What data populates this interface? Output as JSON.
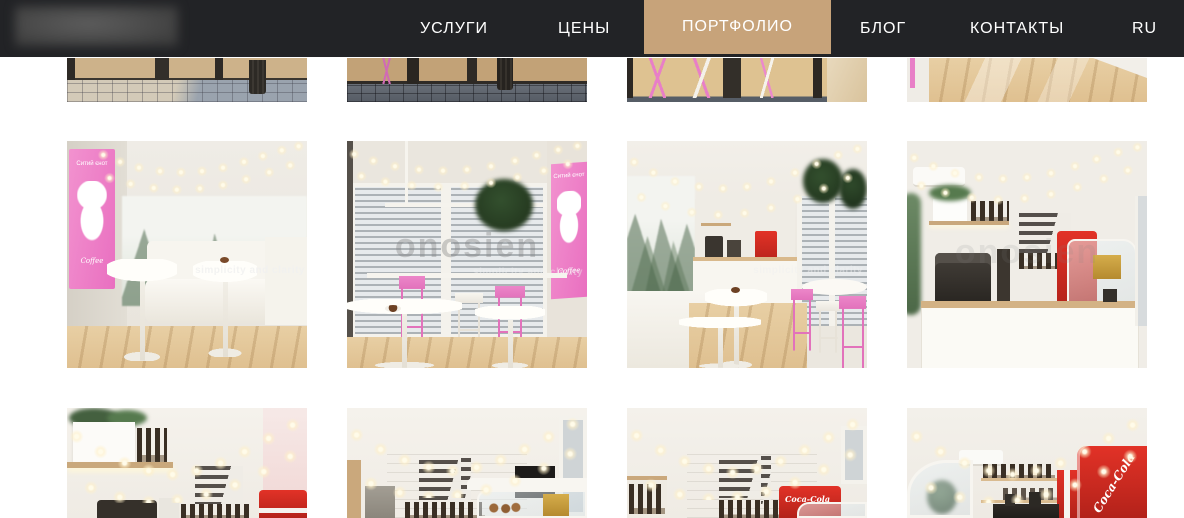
{
  "header": {
    "nav_items": [
      {
        "label": "УСЛУГИ",
        "active": false
      },
      {
        "label": "ЦЕНЫ",
        "active": false
      },
      {
        "label": "ПОРТФОЛИО",
        "active": true
      },
      {
        "label": "БЛОГ",
        "active": false
      },
      {
        "label": "КОНТАКТЫ",
        "active": false
      }
    ],
    "language": "RU",
    "colors": {
      "bar": "#222326",
      "active_bg": "#c7a37a",
      "text": "#ffffff"
    }
  },
  "watermark": {
    "big_text": "onosien",
    "tagline": "simplicity and clarity"
  },
  "mural": {
    "line1": "Ситий єнот",
    "line2": "Coffee"
  },
  "fridge_brand": "Coca-Cola",
  "portfolio": {
    "items": [
      {
        "alt": "Cafe exterior - storefront base and paved sidewalk"
      },
      {
        "alt": "Cafe exterior - entrance doors and dark pavement"
      },
      {
        "alt": "Cafe exterior - pink bar stools seen through the glazing"
      },
      {
        "alt": "Cafe interior - light oak floor detail"
      },
      {
        "alt": "Cafe interior - white sofa, round tables and fir-forest mural with raccoon logo"
      },
      {
        "alt": "Cafe interior - window bar with pink stools and hanging plant"
      },
      {
        "alt": "Cafe interior - full room view with counter, garlands and pink stools"
      },
      {
        "alt": "Cafe interior - service counter with coffee machine, pastry case and Coca-Cola fridge"
      },
      {
        "alt": "Cafe interior - shelf with plants, letter board menu and fridge"
      },
      {
        "alt": "Cafe interior - letter board menu and pastry display"
      },
      {
        "alt": "Cafe interior - counter with Coca-Cola fridge and garlands"
      },
      {
        "alt": "Cafe interior - Coca-Cola fridge, bottle shelves and pastry case"
      }
    ]
  }
}
